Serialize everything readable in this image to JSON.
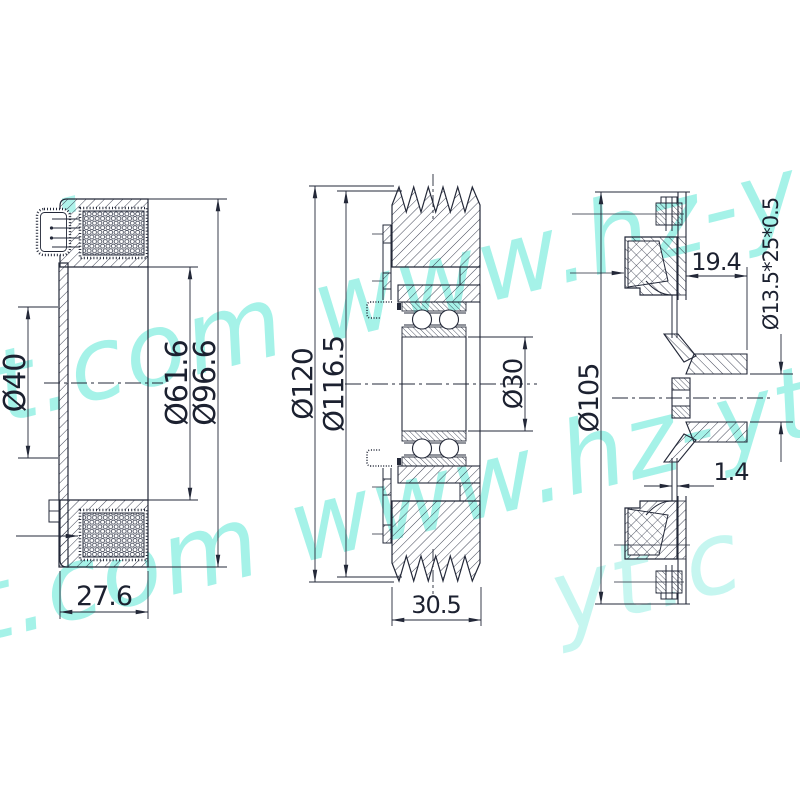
{
  "drawing": {
    "watermark": {
      "text": "www.hz-yt.com",
      "color": "#8fefe3",
      "fragments": [
        "t.com www.hz-y",
        "t.com www.hz-yt",
        "yt.c",
        "hz-yt",
        "."
      ]
    },
    "views": {
      "coil": {
        "label": "coil-side-section",
        "dims": {
          "bore": "Ø40",
          "pocket": "Ø61.6",
          "outer": "Ø96.6",
          "width": "27.6"
        }
      },
      "pulley": {
        "label": "pulley-section",
        "dims": {
          "outer": "Ø120",
          "groove": "Ø116.5",
          "bore": "Ø30",
          "width": "30.5"
        }
      },
      "hub": {
        "label": "hub-disc-section",
        "dims": {
          "outer": "Ø105",
          "depth": "19.4",
          "spec": "Ø13.5*25*0.5",
          "thickness": "1.4"
        }
      }
    }
  }
}
